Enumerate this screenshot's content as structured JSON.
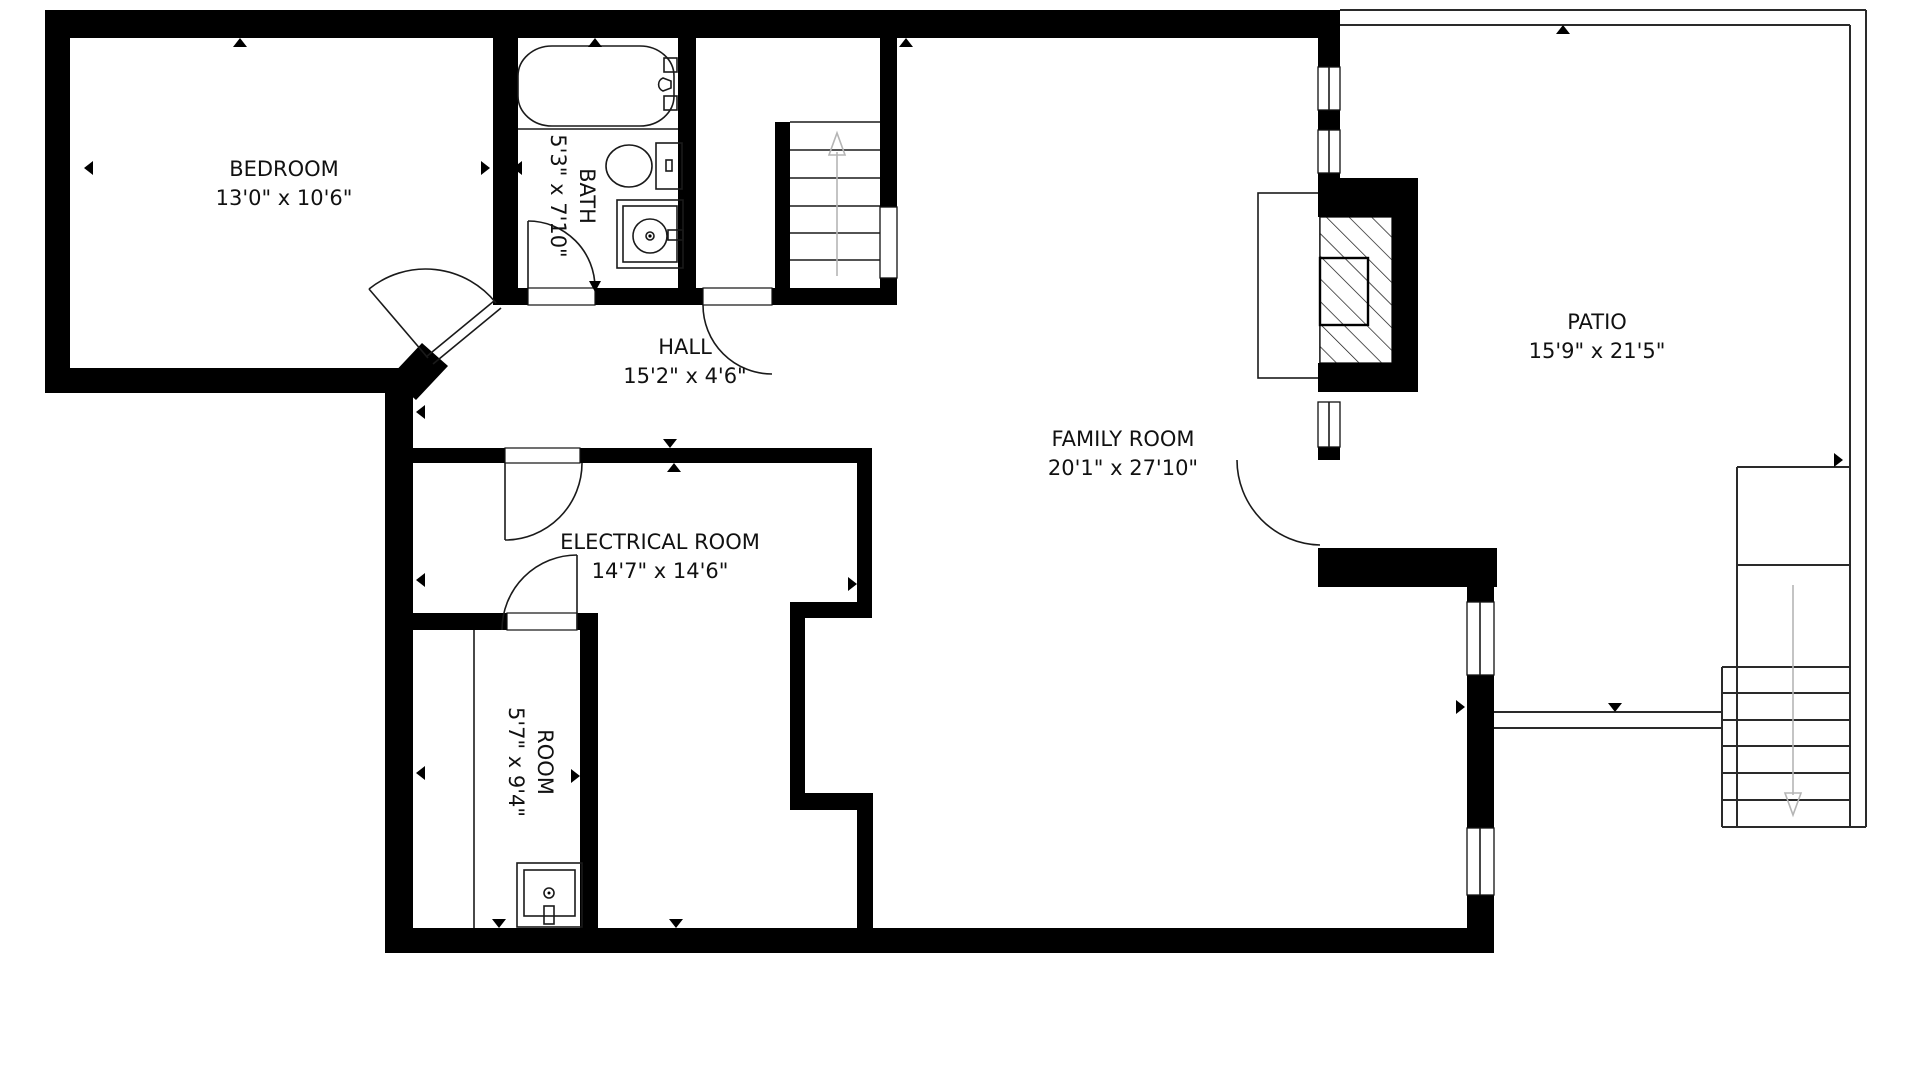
{
  "title": "Basement floor plan",
  "rooms": {
    "bedroom": {
      "name": "BEDROOM",
      "dims": "13'0\" x 10'6\""
    },
    "bath": {
      "name": "BATH",
      "dims": "5'3\" x 7'10\""
    },
    "hall": {
      "name": "HALL",
      "dims": "15'2\" x 4'6\""
    },
    "family_room": {
      "name": "FAMILY ROOM",
      "dims": "20'1\" x 27'10\""
    },
    "electrical_room": {
      "name": "ELECTRICAL ROOM",
      "dims": "14'7\" x 14'6\""
    },
    "room": {
      "name": "ROOM",
      "dims": "5'7\" x 9'4\""
    },
    "patio": {
      "name": "PATIO",
      "dims": "15'9\" x 21'5\""
    }
  },
  "icons": {
    "stairs_up_arrow": "up-direction arrow on interior staircase",
    "stairs_down_arrow": "down-direction arrow on patio staircase"
  },
  "colors": {
    "wall": "#000000",
    "line": "#1a1a1a",
    "faint_arrow": "#b5b5b5",
    "background": "#ffffff"
  }
}
